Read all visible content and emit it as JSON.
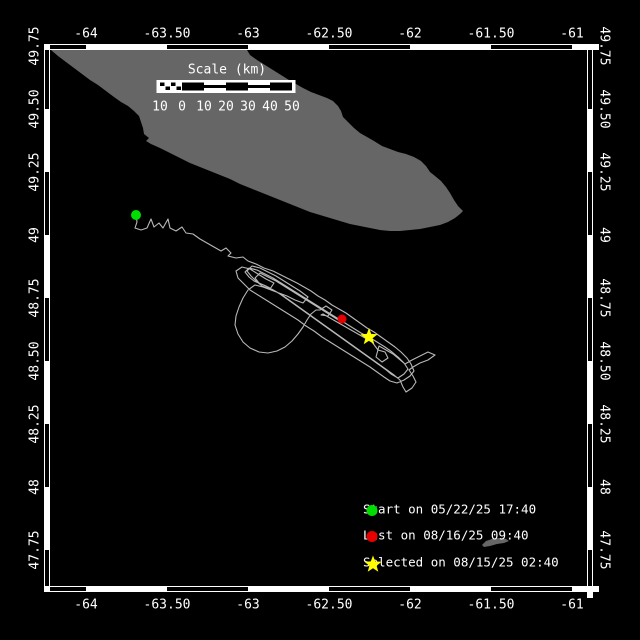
{
  "colors": {
    "background": "#000000",
    "land": "#666666",
    "track": "#b8b8b8",
    "frame_white": "#ffffff",
    "frame_black": "#000000",
    "text": "#ffffff",
    "start_marker": "#00dd00",
    "last_marker": "#e60000",
    "selected_marker": "#ffff00"
  },
  "axes": {
    "longitude": [
      {
        "label": "-64",
        "x": 86
      },
      {
        "label": "-63.50",
        "x": 167
      },
      {
        "label": "-63",
        "x": 248
      },
      {
        "label": "-62.50",
        "x": 329
      },
      {
        "label": "-62",
        "x": 410
      },
      {
        "label": "-61.50",
        "x": 491
      },
      {
        "label": "-61",
        "x": 572
      }
    ],
    "latitude": [
      {
        "label": "49.75",
        "y": 46
      },
      {
        "label": "49.50",
        "y": 109
      },
      {
        "label": "49.25",
        "y": 172
      },
      {
        "label": "49",
        "y": 235
      },
      {
        "label": "48.75",
        "y": 298
      },
      {
        "label": "48.50",
        "y": 361
      },
      {
        "label": "48.25",
        "y": 424
      },
      {
        "label": "48",
        "y": 487
      },
      {
        "label": "47.75",
        "y": 550
      }
    ]
  },
  "frame": {
    "band": {
      "left": 44,
      "top": 44,
      "right": 593,
      "bottom": 592,
      "thickness": 6
    },
    "black_segments_x": [
      [
        50,
        86
      ],
      [
        167,
        248
      ],
      [
        329,
        410
      ],
      [
        491,
        572
      ]
    ],
    "black_segments_y": [
      [
        50,
        109
      ],
      [
        172,
        235
      ],
      [
        298,
        361
      ],
      [
        424,
        487
      ],
      [
        550,
        586
      ]
    ]
  },
  "scale_bar": {
    "title": "Scale (km)",
    "title_x": 227,
    "title_y": 70,
    "x0": 160,
    "cell_w": 22,
    "bar_y": 82.5,
    "bar_h": 8,
    "ticks": [
      "10",
      "0",
      "10",
      "20",
      "30",
      "40",
      "50"
    ],
    "ticks_y": 107,
    "pattern": [
      "checker",
      "black",
      "stripe",
      "black",
      "stripe",
      "black"
    ]
  },
  "legend": {
    "items": [
      {
        "marker": "circle",
        "color": "#00dd00",
        "label": "Start on 05/22/25 17:40",
        "y": 509
      },
      {
        "marker": "circle",
        "color": "#e60000",
        "label": "Last on 08/16/25 09:40",
        "y": 535
      },
      {
        "marker": "star",
        "color": "#ffff00",
        "label": "Selected on 08/15/25 02:40",
        "y": 562
      }
    ]
  },
  "map": {
    "markers": [
      {
        "name": "start",
        "type": "circle",
        "x": 136,
        "y": 215,
        "r": 5,
        "color": "#00dd00"
      },
      {
        "name": "last",
        "type": "circle",
        "x": 342,
        "y": 319,
        "r": 4.5,
        "color": "#e60000"
      },
      {
        "name": "selected",
        "type": "star",
        "x": 369,
        "y": 337,
        "r": 9,
        "color": "#ffff00"
      }
    ],
    "island_points": [
      [
        51,
        50
      ],
      [
        58,
        56
      ],
      [
        66,
        62
      ],
      [
        74,
        68
      ],
      [
        82,
        74
      ],
      [
        90,
        80
      ],
      [
        98,
        85
      ],
      [
        106,
        91
      ],
      [
        114,
        97
      ],
      [
        121,
        102
      ],
      [
        128,
        106
      ],
      [
        134,
        111
      ],
      [
        139,
        116
      ],
      [
        141,
        122
      ],
      [
        143,
        128
      ],
      [
        144,
        134
      ],
      [
        149,
        138
      ],
      [
        146,
        141
      ],
      [
        151,
        144
      ],
      [
        160,
        148
      ],
      [
        170,
        153
      ],
      [
        180,
        158
      ],
      [
        190,
        163
      ],
      [
        200,
        167
      ],
      [
        210,
        171
      ],
      [
        220,
        175
      ],
      [
        230,
        179
      ],
      [
        240,
        184
      ],
      [
        250,
        188
      ],
      [
        260,
        192
      ],
      [
        270,
        196
      ],
      [
        280,
        200
      ],
      [
        290,
        204
      ],
      [
        300,
        208
      ],
      [
        310,
        212
      ],
      [
        320,
        215
      ],
      [
        330,
        218
      ],
      [
        340,
        221
      ],
      [
        350,
        224
      ],
      [
        360,
        226
      ],
      [
        370,
        228
      ],
      [
        380,
        230
      ],
      [
        390,
        231
      ],
      [
        400,
        231
      ],
      [
        410,
        230
      ],
      [
        420,
        229
      ],
      [
        430,
        227
      ],
      [
        440,
        225
      ],
      [
        448,
        222
      ],
      [
        455,
        218
      ],
      [
        460,
        214
      ],
      [
        463,
        211
      ],
      [
        458,
        206
      ],
      [
        454,
        200
      ],
      [
        450,
        193
      ],
      [
        446,
        187
      ],
      [
        441,
        181
      ],
      [
        435,
        176
      ],
      [
        430,
        172
      ],
      [
        426,
        166
      ],
      [
        421,
        161
      ],
      [
        414,
        157
      ],
      [
        406,
        154
      ],
      [
        398,
        152
      ],
      [
        390,
        149
      ],
      [
        382,
        146
      ],
      [
        374,
        141
      ],
      [
        367,
        137
      ],
      [
        360,
        133
      ],
      [
        354,
        128
      ],
      [
        348,
        122
      ],
      [
        343,
        117
      ],
      [
        341,
        111
      ],
      [
        338,
        106
      ],
      [
        333,
        101
      ],
      [
        327,
        98
      ],
      [
        319,
        95
      ],
      [
        311,
        92
      ],
      [
        303,
        88
      ],
      [
        296,
        84
      ],
      [
        289,
        80
      ],
      [
        281,
        75
      ],
      [
        273,
        70
      ],
      [
        265,
        65
      ],
      [
        257,
        60
      ],
      [
        250,
        55
      ],
      [
        247,
        50
      ]
    ],
    "islet_points": [
      [
        482,
        545
      ],
      [
        486,
        541
      ],
      [
        492,
        539
      ],
      [
        499,
        538
      ],
      [
        506,
        539
      ],
      [
        509,
        541
      ],
      [
        504,
        543
      ],
      [
        497,
        544
      ],
      [
        490,
        546
      ],
      [
        484,
        547
      ]
    ],
    "track_points": [
      [
        136,
        215
      ],
      [
        137,
        222
      ],
      [
        135,
        228
      ],
      [
        141,
        230
      ],
      [
        147,
        228
      ],
      [
        151,
        219
      ],
      [
        154,
        227
      ],
      [
        159,
        223
      ],
      [
        163,
        228
      ],
      [
        168,
        219
      ],
      [
        170,
        228
      ],
      [
        176,
        231
      ],
      [
        182,
        227
      ],
      [
        186,
        233
      ],
      [
        193,
        234
      ],
      [
        200,
        239
      ],
      [
        207,
        243
      ],
      [
        214,
        247
      ],
      [
        221,
        251
      ],
      [
        226,
        248
      ],
      [
        231,
        253
      ],
      [
        228,
        256
      ],
      [
        236,
        258
      ],
      [
        243,
        257
      ],
      [
        248,
        261
      ],
      [
        256,
        264
      ],
      [
        264,
        268
      ],
      [
        273,
        271
      ],
      [
        281,
        275
      ],
      [
        289,
        279
      ],
      [
        297,
        283
      ],
      [
        304,
        287
      ],
      [
        311,
        291
      ],
      [
        318,
        296
      ],
      [
        325,
        300
      ],
      [
        332,
        305
      ],
      [
        339,
        309
      ],
      [
        346,
        313
      ],
      [
        353,
        318
      ],
      [
        360,
        323
      ],
      [
        367,
        328
      ],
      [
        374,
        332
      ],
      [
        381,
        337
      ],
      [
        388,
        342
      ],
      [
        395,
        347
      ],
      [
        401,
        352
      ],
      [
        407,
        358
      ],
      [
        411,
        364
      ],
      [
        414,
        371
      ],
      [
        410,
        376
      ],
      [
        404,
        380
      ],
      [
        397,
        383
      ],
      [
        390,
        381
      ],
      [
        384,
        377
      ],
      [
        377,
        372
      ],
      [
        370,
        367
      ],
      [
        362,
        362
      ],
      [
        354,
        357
      ],
      [
        346,
        352
      ],
      [
        338,
        347
      ],
      [
        330,
        342
      ],
      [
        322,
        337
      ],
      [
        314,
        331
      ],
      [
        306,
        326
      ],
      [
        298,
        320
      ],
      [
        290,
        315
      ],
      [
        282,
        310
      ],
      [
        274,
        305
      ],
      [
        266,
        300
      ],
      [
        258,
        295
      ],
      [
        250,
        290
      ],
      [
        244,
        284
      ],
      [
        238,
        278
      ],
      [
        236,
        271
      ],
      [
        242,
        267
      ],
      [
        250,
        269
      ],
      [
        258,
        274
      ],
      [
        266,
        279
      ],
      [
        274,
        283
      ],
      [
        270,
        289
      ],
      [
        262,
        286
      ],
      [
        256,
        281
      ],
      [
        251,
        276
      ],
      [
        247,
        271
      ],
      [
        252,
        266
      ],
      [
        260,
        268
      ],
      [
        268,
        272
      ],
      [
        276,
        276
      ],
      [
        284,
        281
      ],
      [
        292,
        286
      ],
      [
        300,
        291
      ],
      [
        308,
        297
      ],
      [
        303,
        303
      ],
      [
        295,
        300
      ],
      [
        287,
        296
      ],
      [
        279,
        293
      ],
      [
        271,
        290
      ],
      [
        263,
        287
      ],
      [
        255,
        285
      ],
      [
        248,
        290
      ],
      [
        243,
        298
      ],
      [
        239,
        307
      ],
      [
        236,
        316
      ],
      [
        235,
        325
      ],
      [
        238,
        334
      ],
      [
        243,
        342
      ],
      [
        250,
        348
      ],
      [
        259,
        352
      ],
      [
        268,
        353
      ],
      [
        277,
        351
      ],
      [
        285,
        347
      ],
      [
        292,
        341
      ],
      [
        298,
        334
      ],
      [
        303,
        327
      ],
      [
        307,
        320
      ],
      [
        311,
        314
      ],
      [
        316,
        310
      ],
      [
        320,
        310
      ],
      [
        326,
        306
      ],
      [
        332,
        310
      ],
      [
        328,
        316
      ],
      [
        321,
        315
      ],
      [
        323,
        314
      ],
      [
        330,
        318
      ],
      [
        337,
        322
      ],
      [
        344,
        326
      ],
      [
        351,
        330
      ],
      [
        358,
        334
      ],
      [
        365,
        338
      ],
      [
        372,
        342
      ],
      [
        378,
        350
      ],
      [
        385,
        352
      ],
      [
        388,
        358
      ],
      [
        382,
        362
      ],
      [
        376,
        357
      ],
      [
        379,
        346
      ],
      [
        386,
        350
      ],
      [
        393,
        354
      ],
      [
        399,
        359
      ],
      [
        405,
        364
      ],
      [
        412,
        360
      ],
      [
        420,
        356
      ],
      [
        428,
        352
      ],
      [
        435,
        355
      ],
      [
        428,
        360
      ],
      [
        420,
        363
      ],
      [
        413,
        367
      ],
      [
        409,
        370
      ],
      [
        413,
        376
      ],
      [
        416,
        382
      ],
      [
        412,
        388
      ],
      [
        406,
        392
      ],
      [
        403,
        387
      ],
      [
        400,
        380
      ],
      [
        394,
        375
      ],
      [
        387,
        370
      ],
      [
        380,
        365
      ],
      [
        373,
        360
      ],
      [
        366,
        355
      ],
      [
        359,
        350
      ],
      [
        352,
        345
      ],
      [
        345,
        340
      ],
      [
        338,
        335
      ],
      [
        331,
        330
      ],
      [
        324,
        325
      ],
      [
        317,
        320
      ],
      [
        310,
        315
      ],
      [
        303,
        310
      ],
      [
        296,
        305
      ],
      [
        289,
        300
      ],
      [
        282,
        295
      ],
      [
        275,
        291
      ],
      [
        268,
        287
      ],
      [
        261,
        284
      ],
      [
        254,
        281
      ],
      [
        249,
        277
      ],
      [
        245,
        272
      ],
      [
        249,
        268
      ],
      [
        257,
        270
      ],
      [
        265,
        274
      ],
      [
        273,
        278
      ],
      [
        281,
        283
      ],
      [
        289,
        288
      ],
      [
        297,
        293
      ],
      [
        305,
        298
      ],
      [
        313,
        303
      ],
      [
        321,
        308
      ],
      [
        329,
        313
      ],
      [
        337,
        318
      ],
      [
        345,
        323
      ],
      [
        353,
        328
      ],
      [
        361,
        333
      ],
      [
        369,
        337
      ],
      [
        377,
        342
      ],
      [
        385,
        347
      ],
      [
        392,
        352
      ],
      [
        398,
        357
      ],
      [
        404,
        363
      ],
      [
        408,
        369
      ],
      [
        404,
        374
      ],
      [
        398,
        378
      ],
      [
        391,
        374
      ],
      [
        385,
        369
      ],
      [
        378,
        364
      ],
      [
        371,
        359
      ],
      [
        364,
        354
      ],
      [
        357,
        349
      ],
      [
        350,
        344
      ],
      [
        343,
        339
      ],
      [
        336,
        334
      ],
      [
        329,
        329
      ],
      [
        322,
        324
      ],
      [
        315,
        319
      ],
      [
        308,
        314
      ],
      [
        301,
        309
      ],
      [
        294,
        304
      ],
      [
        287,
        299
      ],
      [
        280,
        294
      ],
      [
        273,
        290
      ],
      [
        266,
        286
      ],
      [
        259,
        283
      ],
      [
        255,
        278
      ],
      [
        260,
        273
      ],
      [
        268,
        277
      ],
      [
        276,
        281
      ],
      [
        284,
        286
      ],
      [
        292,
        291
      ],
      [
        300,
        296
      ],
      [
        308,
        301
      ],
      [
        316,
        306
      ],
      [
        324,
        311
      ],
      [
        332,
        316
      ],
      [
        340,
        321
      ],
      [
        342,
        319
      ]
    ]
  }
}
